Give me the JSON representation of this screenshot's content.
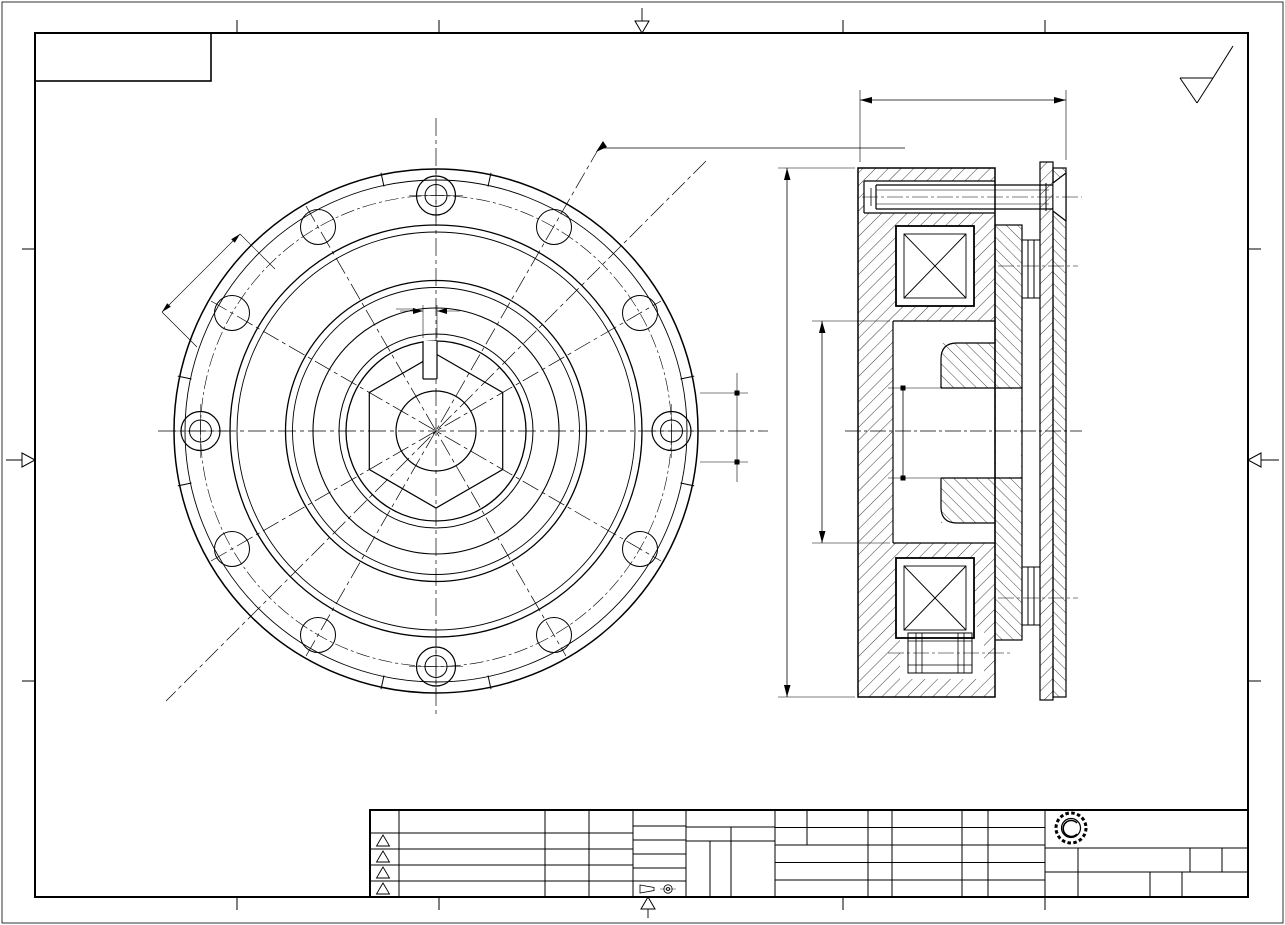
{
  "banner": {
    "text": "由 Autodesk 教育版产品制作"
  },
  "border": {
    "letters": [
      "F",
      "E",
      "D",
      "C",
      "B",
      "A"
    ],
    "numbers": [
      "1",
      "2",
      "3",
      "4"
    ]
  },
  "finish": {
    "ra": "Ra3.2",
    "note": "未注:  R1"
  },
  "front": {
    "lead": "ø112(4-M6安装螺钉90°均布)",
    "d15": "15",
    "d5": "5",
    "d228": "22,8"
  },
  "section": {
    "d502": "50,2",
    "d125": "ø125",
    "d52": "ø52",
    "d52u": "+0.038",
    "d52d": "+0.01",
    "d20": "ø20",
    "d20u": "+0.05",
    "d20d": "+0.03",
    "bolt": "M6×35L",
    "bolt2": "M6×35L",
    "thread": "M6"
  },
  "rev": {
    "h": [
      "版次",
      "更改内容",
      "更改人",
      "日期"
    ],
    "marks": [
      "A",
      "B",
      "C",
      "D"
    ]
  },
  "proc": {
    "r1": "其余Ra6.3",
    "r2": "车T",
    "r3": "铣T",
    "r4": "钳T",
    "c1": "未注公差",
    "c2": "按GB/T1804",
    "c3": "0.5-3",
    "c4": "±0.1",
    "big": "m级"
  },
  "info": {
    "drawn_l": "制图",
    "drawn": "张昌开",
    "date_l": "日期",
    "date": "2017.11.16",
    "check_l": "校正",
    "audit_l": "审核",
    "mat_l": "材质",
    "mat": "45#",
    "heat_l": "热处理",
    "surf_l": "表面处理",
    "scale_l": "比例",
    "note1": "未注圆角为",
    "note2": "未注倒角为",
    "note3": "全部锐边及毛刺倒钝"
  },
  "co": {
    "name": "东莞合机有限公司",
    "name_l": "名称",
    "product": "TJ-D2.5KG断电刹车",
    "rev_l": "版次",
    "rev": "0",
    "type_l": "机种",
    "type": "电磁",
    "no_l": "图号",
    "no": "0"
  }
}
